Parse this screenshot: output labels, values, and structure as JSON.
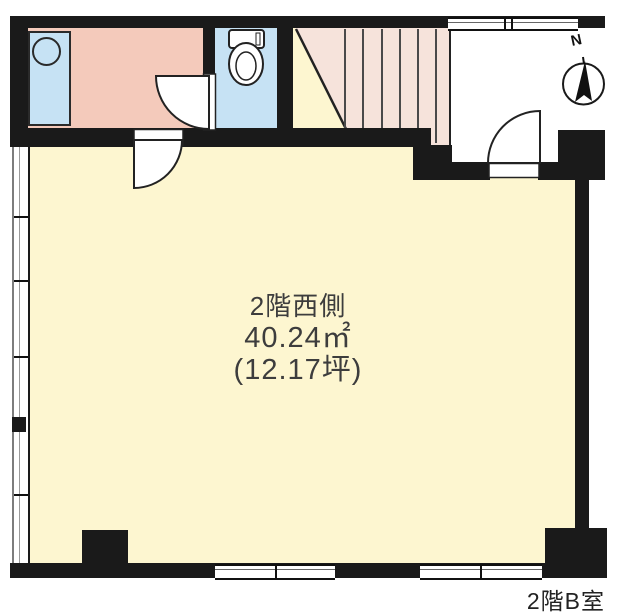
{
  "floorplan": {
    "room_label": [
      "2階西側",
      "40.24㎡",
      "(12.17坪)"
    ],
    "unit_label": "2階B室",
    "compass_label": "N",
    "colors": {
      "wall": "#1a1a1a",
      "main_room": "#fdf6d0",
      "washroom": "#f4cabb",
      "fixture_blue": "#c6e2f4",
      "stairs": "#f6e3db",
      "label_text": "#3d3d3d"
    },
    "icons": [
      "compass-icon",
      "toilet-icon",
      "sink-icon",
      "door-swing-icon",
      "stairs-icon"
    ]
  }
}
